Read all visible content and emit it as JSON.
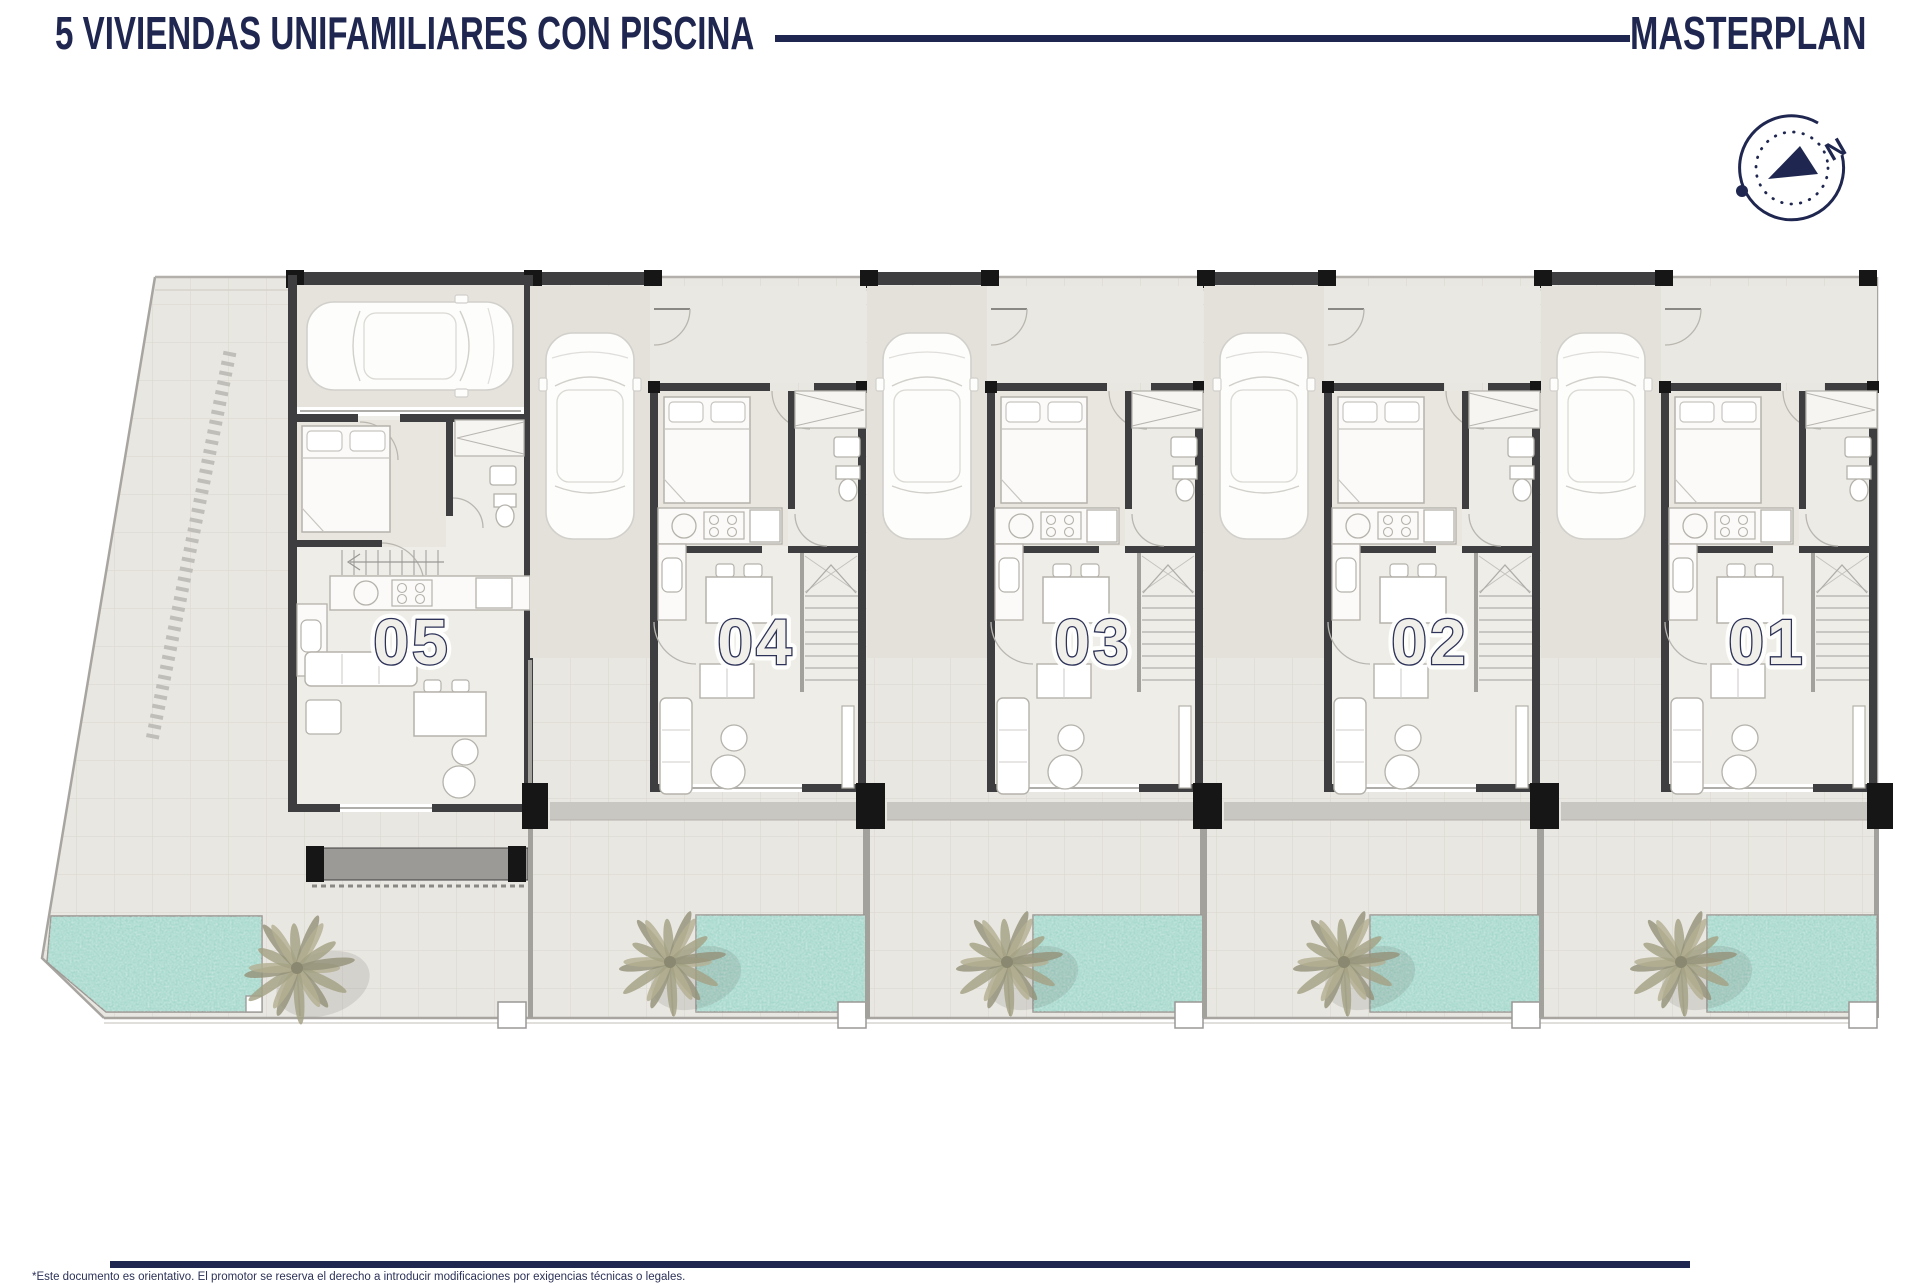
{
  "header": {
    "title": "5 VIVIENDAS UNIFAMILIARES CON PISCINA",
    "right_label": "MASTERPLAN"
  },
  "compass": {
    "north_label": "N"
  },
  "plan": {
    "units": [
      {
        "label": "05"
      },
      {
        "label": "04"
      },
      {
        "label": "03"
      },
      {
        "label": "02"
      },
      {
        "label": "01"
      }
    ]
  },
  "footer": {
    "disclaimer": "*Este documento es orientativo. El promotor se reserva el derecho a introducir modificaciones por exigencias técnicas o legales."
  },
  "colors": {
    "navy": "#1f2750",
    "site_fill": "#e9e7e1",
    "tile_line": "#dcd8d1",
    "wall_dark": "#3e3e40",
    "column_black": "#161616",
    "wall_gray": "#a3a19c",
    "band_gray": "#c9c7c2",
    "pool": "#a6d8cc",
    "palm": "#a9a688",
    "furniture_stroke": "#b5b2ab"
  }
}
